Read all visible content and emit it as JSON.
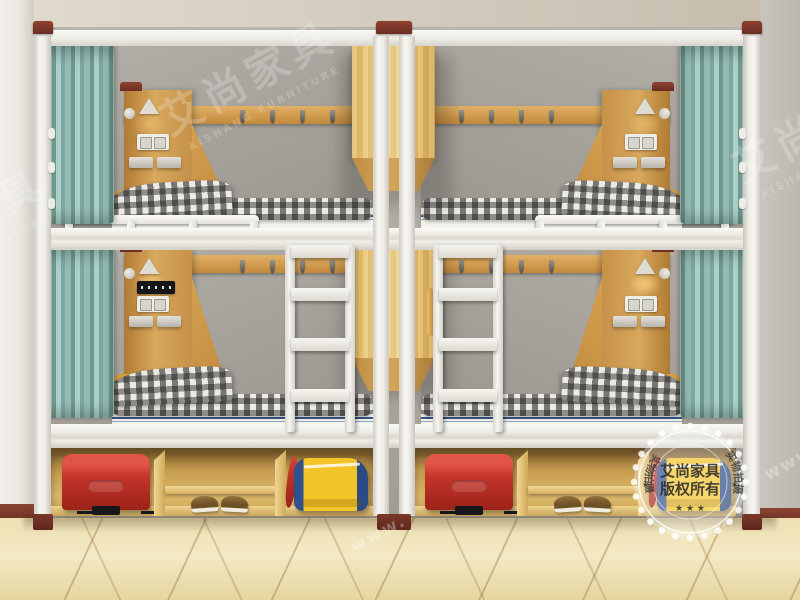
{
  "watermark": {
    "brand": "艾尚家具",
    "brand_latin": "AISHANG FURNITURE",
    "url_fragment": "www.",
    "seal": {
      "title": "艾尚家具",
      "subtitle": "版权所有",
      "ring_left": "实物拍摄",
      "ring_right": "实物拍摄",
      "stars": "★ ★ ★",
      "star_left": "★",
      "star_right": "★"
    }
  },
  "palette": {
    "frame_white": "#f2f0ea",
    "wood_headboard": "#c9964a",
    "wood_cabinet": "#ecca7e",
    "curtain_teal": "#8fb8b0",
    "wall_grey": "#a9a59f",
    "ceiling_beige": "#d6cec1",
    "floor_cream": "#eee0b2",
    "post_cap_red": "#7e352a",
    "suitcase_red": "#c5352b",
    "bag_yellow": "#f2c52a",
    "bag_blue": "#31508e",
    "pillow_orange": "#e2a33b",
    "mattress_stripe_blue": "#35598a",
    "blanket_check_dark": "#2a2a2a"
  }
}
